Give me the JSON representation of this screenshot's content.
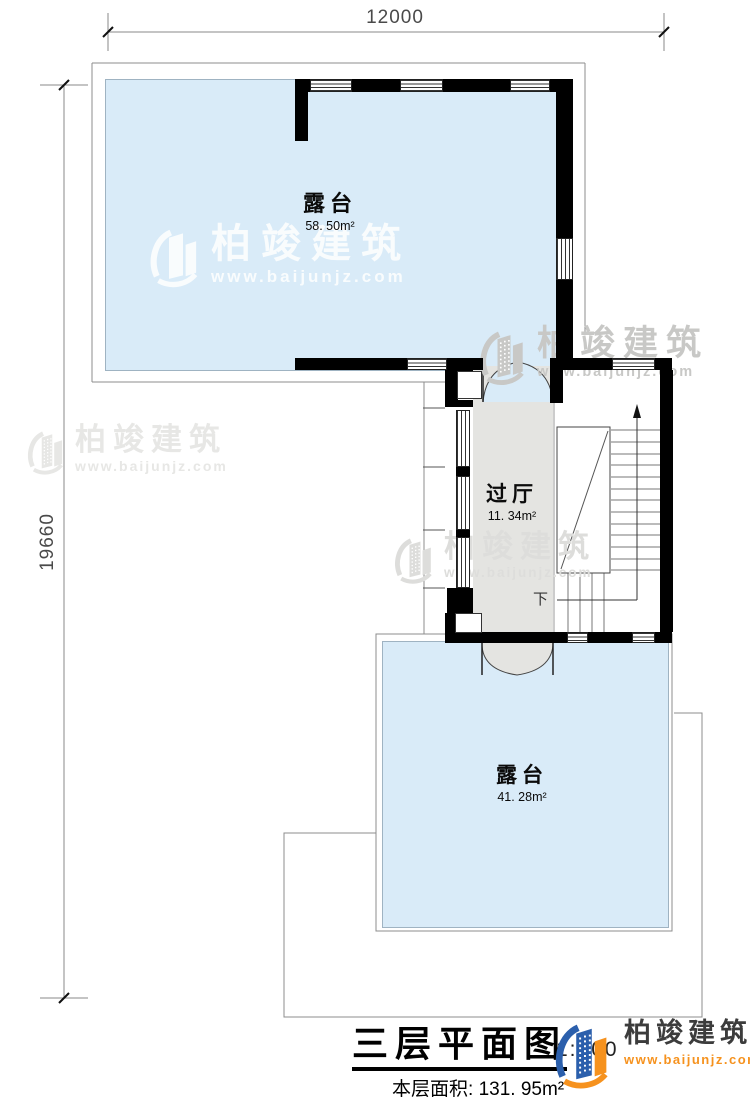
{
  "dimensions": {
    "top": "12000",
    "left": "19660"
  },
  "rooms": [
    {
      "name": "露台",
      "area": "58. 50m²"
    },
    {
      "name": "过厅",
      "area": "11. 34m²"
    },
    {
      "name": "露台",
      "area": "41. 28m²"
    }
  ],
  "stairs": {
    "down_label": "下"
  },
  "watermark": {
    "brand": "柏竣建筑",
    "url": "www.baijunjz.com"
  },
  "title_block": {
    "title": "三层平面图",
    "scale": "1:100",
    "area_label": "本层面积:",
    "area_value": "131. 95m²"
  },
  "logo": {
    "brand": "柏竣建筑",
    "url": "www.baijunjz.com"
  },
  "colors": {
    "terrace_fill": "#D9EBF8",
    "hall_fill": "#E4E4E1",
    "wall": "#000000",
    "outline": "#8C8C8C",
    "logo_blue": "#2B5FAC",
    "logo_orange": "#F6921E"
  }
}
